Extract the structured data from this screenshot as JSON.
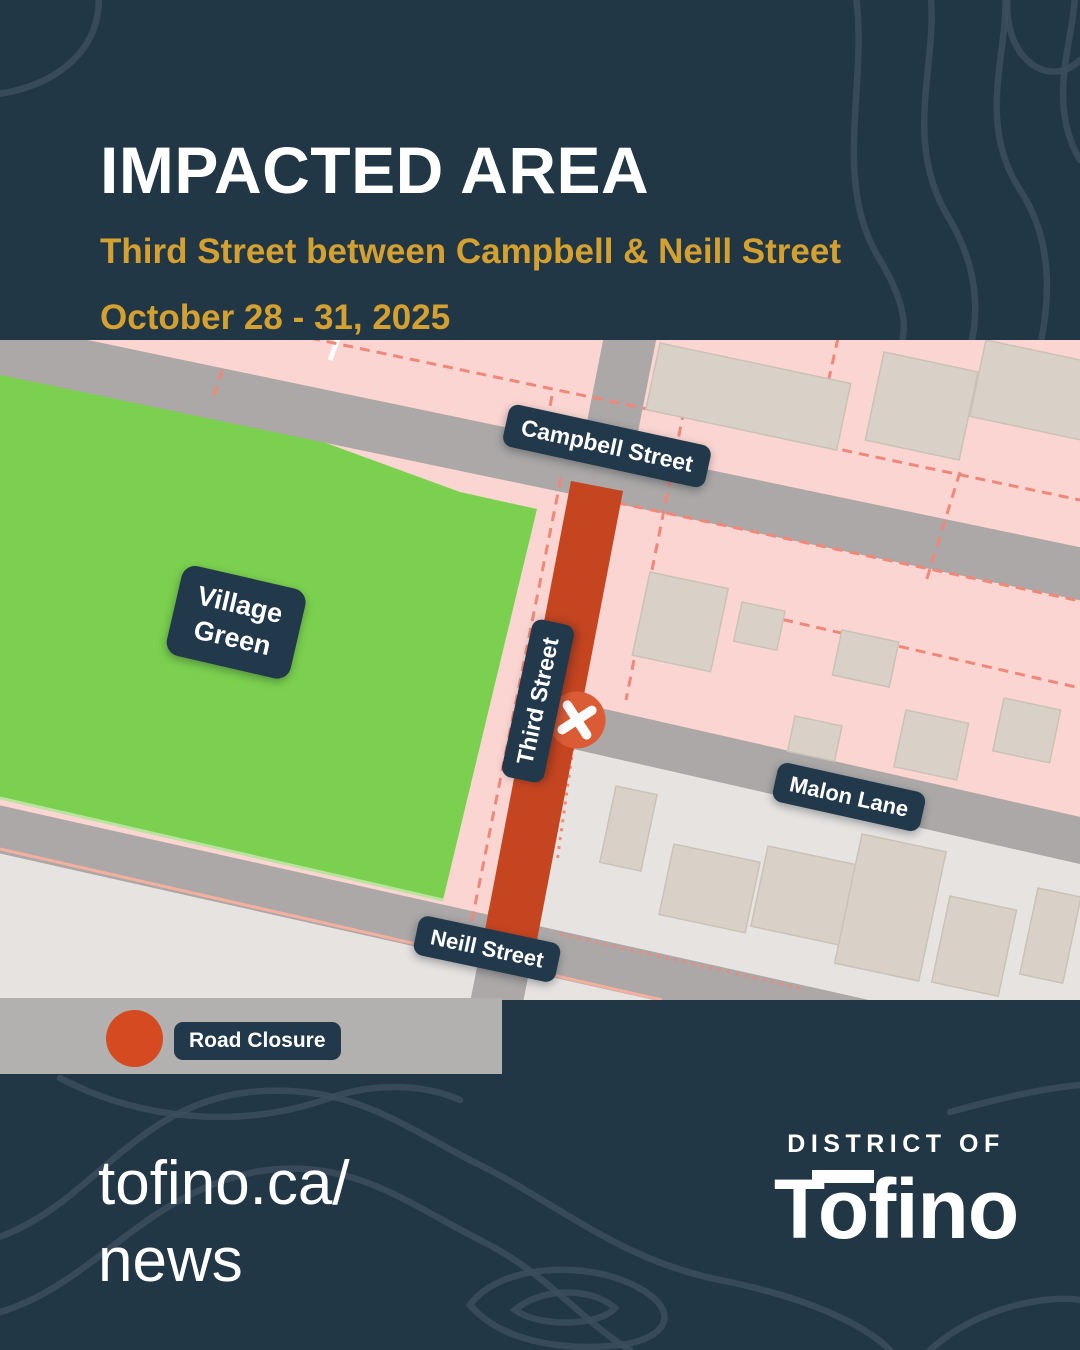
{
  "poster": {
    "header": {
      "title": "IMPACTED AREA",
      "subtitle": "Third Street between Campbell & Neill Street",
      "date_range": "October 28 - 31, 2025"
    },
    "map": {
      "street_labels": {
        "campbell": "Campbell Street",
        "third": "Third Street",
        "malon": "Malon Lane",
        "neill": "Neill Street"
      },
      "area_labels": {
        "village_green_line1": "Village",
        "village_green_line2": "Green"
      },
      "marker": "road-closed-x-marker"
    },
    "legend": {
      "items": [
        {
          "label": "Road Closure",
          "swatch_color": "#D54A20"
        }
      ]
    },
    "footer": {
      "url_line1": "tofino.ca/",
      "url_line2": "news",
      "logo_line1": "DISTRICT OF",
      "logo_line2": "Tofino"
    },
    "colors": {
      "background_navy": "#223745",
      "contour_line": "#3A4E5D",
      "accent_gold": "#D4A02F",
      "map_pink": "#FAD5D1",
      "park_green": "#7BD14F",
      "road_gray": "#ABA8A7",
      "zone_light_gray": "#E6E3E1",
      "building_beige": "#D9D1C8",
      "closure_red": "#C54520",
      "marker_orange": "#DB5B35",
      "label_navy": "#22384B",
      "parcel_dash_salmon": "#F0887A",
      "legend_band_gray": "#B3B0B0"
    }
  }
}
